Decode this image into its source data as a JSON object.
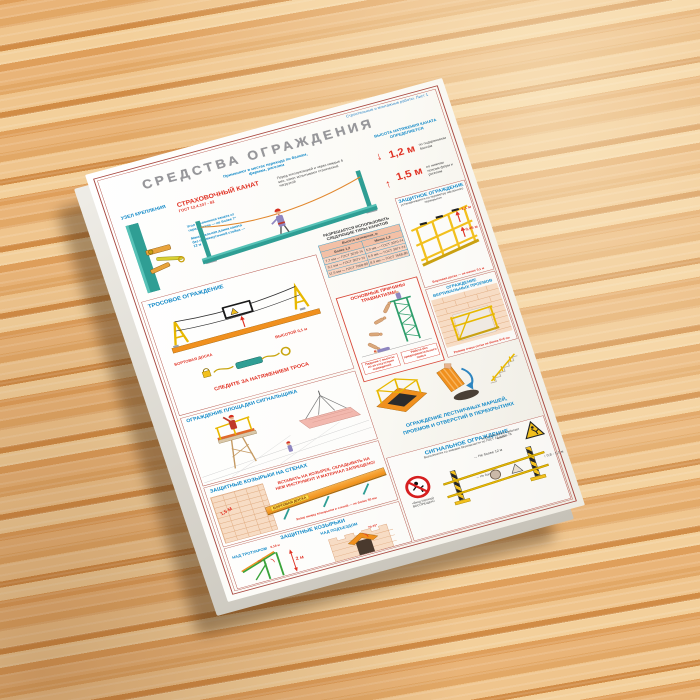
{
  "poster": {
    "edition_note": "Строительные и монтажные работы. Лист 1",
    "title": "СРЕДСТВА ОГРАЖДЕНИЯ",
    "rope": {
      "title": "СТРАХОВОЧНЫЙ КАНАТ",
      "gost": "ГОСТ 12.4.107 - 82",
      "usage": "Применяют в местах перехода по балкам, фермам, ригелям",
      "test": "Перед эксплуатацией и через каждые 6 мес. канат испытывают статической нагрузкой",
      "angle": "Угол отклонения каната от горизонтали — не более 7°",
      "length": "Максимальная длина каната без промежуточной стойки — 12 м",
      "hh": "ВЫСОТА НАТЯЖЕНИЯ КАНАТА ОПРЕДЕЛЯЕТСЯ",
      "h1": "1,2 м",
      "h1n": "по подкрановым балкам",
      "h2": "1,5 м",
      "h2n": "по нижним поясам ферм и ригелям"
    },
    "node": {
      "title": "УЗЕЛ КРЕПЛЕНИЯ"
    },
    "cable": {
      "title": "ТРОСОВОЕ ОГРАЖДЕНИЕ",
      "board": "БОРТОВАЯ ДОСКА",
      "bheight": "ВЫСОТОЙ 0,1 м",
      "tension": "СЛЕДИТЕ ЗА НАТЯЖЕНИЕМ ТРОСА"
    },
    "types": {
      "heading": "РАЗРЕШАЕТСЯ ИСПОЛЬЗОВАТЬ СЛЕДУЮЩИЕ ТИПЫ КАНАТОВ",
      "thead": "Высота натяжения, м",
      "col1": "Более 1,2",
      "col2": "Менее 1,2",
      "rows": [
        {
          "c0": "7,7 мм — ГОСТ 3070-74",
          "c1": "5,9 мм — ГОСТ 3070-74"
        },
        {
          "c0": "9,1 мм — ГОСТ 3071-74",
          "c1": "6,9 мм — ГОСТ 3071-74"
        },
        {
          "c0": "11,5 мм — ГОСТ 7668-80",
          "c1": "8,3 мм — ГОСТ 7668-80"
        }
      ]
    },
    "causes": {
      "title": "ОСНОВНЫЕ ПРИЧИНЫ ТРАВМАТИЗМА",
      "cap1": "Падение с высоты из-за отсутствия ограждений",
      "cap2": "Работа без предохранительного пояса"
    },
    "guard": {
      "title": "ЗАЩИТНОЕ ОГРАЖДЕНИЕ",
      "sub": "устанавливается по периметру наклонного перекрытия",
      "m1": "1,1 м",
      "m2": "0,45 м",
      "note": "Бортовая доска — не менее 0,1 м"
    },
    "vert": {
      "title": "ОГРАЖДЕНИЕ ВЕРТИКАЛЬНЫХ ПРОЕМОВ",
      "note": "Размер ячеек сетки не более 5×5 см"
    },
    "stairs": {
      "title1": "ОГРАЖДЕНИЕ ЛЕСТНИЧНЫХ МАРШЕЙ,",
      "title2": "ПРОЕМОВ И ОТВЕРСТИЙ В ПЕРЕКРЫТИЯХ"
    },
    "signaller": {
      "title": "ОГРАЖДЕНИЕ ПЛОЩАДКИ СИГНАЛЬЩИКА"
    },
    "wallcanopy": {
      "title": "ЗАЩИТНЫЕ КОЗЫРЬКИ НА СТЕНАХ",
      "warn1": "ВСТАВАТЬ НА КОЗЫРЕК, СКЛАДЫВАТЬ НА",
      "warn2": "НЕМ ИНСТРУМЕНТ И МАТЕРИАЛ ЗАПРЕЩЕНО!",
      "m": "1,5 М",
      "board": "БОРТОВАЯ ДОСКА",
      "gap": "Зазор между козырьком и стеной — не более 50 мм"
    },
    "canopies": {
      "title": "ЗАЩИТНЫЕ КОЗЫРЬКИ",
      "left": "НАД ТРОТУАРОМ",
      "right": "НАД ПОДЪЕЗДОМ",
      "h": "2 м",
      "a1": "70°",
      "t": "0,18 м",
      "a2": "70-75°"
    },
    "signal": {
      "title": "СИГНАЛЬНОЕ ОГРАЖДЕНИЕ",
      "sub": "Выполняется со знаками безопасности по ГОСТ 12.4.026-76",
      "s1": "«Вход (проход) ВОСПРЕЩЕН»",
      "s2": "«ОСТОРОЖНО! Работает кран!»",
      "d1": "Не более 12 м",
      "d2": "Не более 6 м",
      "h": "0,8 - 1,1 м"
    }
  },
  "icons": {
    "down_arrow": "↓",
    "up_arrow": "↑",
    "left_right_arrow": "↔",
    "up_down_arrow": "↕"
  },
  "colors": {
    "border_red": "#a8463e",
    "title_gray": "#97979b",
    "blue": "#1289c7",
    "red": "#e03123",
    "yellow": "#f2c01d",
    "orange": "#f0901e",
    "teal": "#2f9e94",
    "green": "#3aa33a"
  }
}
